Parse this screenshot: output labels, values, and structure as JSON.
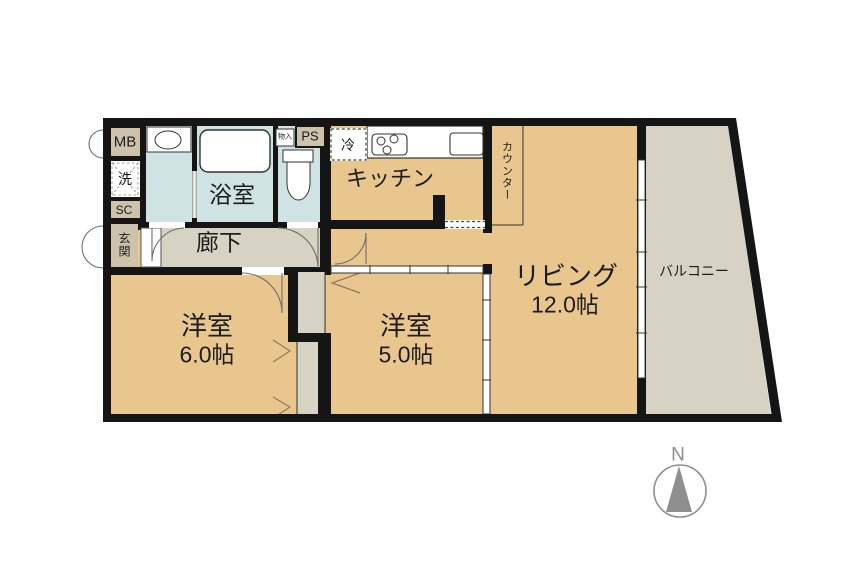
{
  "colors": {
    "room_beige": "#e8c68e",
    "floor_gray": "#d6d2c4",
    "water_blue": "#cfe3e2",
    "box_tan": "#cdc3ac",
    "wall": "#151515",
    "compass_gray": "#8f8f8f"
  },
  "plan": {
    "living": {
      "name": "リビング",
      "size": "12.0帖"
    },
    "bedroom6": {
      "name": "洋室",
      "size": "6.0帖"
    },
    "bedroom5": {
      "name": "洋室",
      "size": "5.0帖"
    },
    "kitchen": {
      "name": "キッチン"
    },
    "bath": {
      "name": "浴室"
    },
    "hallway": {
      "name": "廊下"
    },
    "entrance": {
      "name": "玄関"
    },
    "balcony": {
      "name": "バルコニー"
    },
    "counter": {
      "name": "カウンター"
    },
    "meter_box": {
      "name": "MB"
    },
    "pipe_space": {
      "name": "PS"
    },
    "shoe_closet": {
      "name": "SC"
    },
    "laundry": {
      "name": "洗"
    },
    "refrigerator": {
      "name": "冷"
    },
    "storage": {
      "name": "物入"
    },
    "compass_north": {
      "name": "N"
    }
  }
}
